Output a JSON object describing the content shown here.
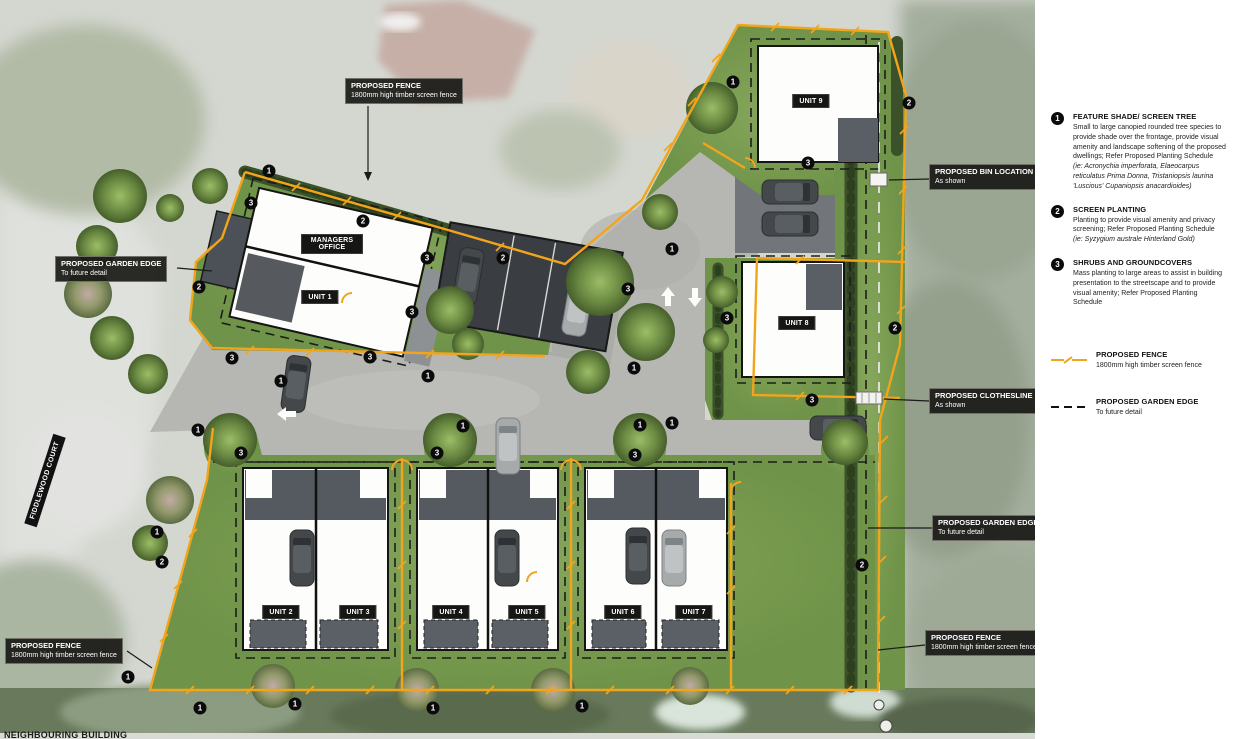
{
  "street_label": "FIDDLEWOOD COURT",
  "cropped_bottom_label": "NEIGHBOURING BUILDING",
  "units": [
    "MANAGERS OFFICE",
    "UNIT 1",
    "UNIT 2",
    "UNIT 3",
    "UNIT 4",
    "UNIT 5",
    "UNIT 6",
    "UNIT 7",
    "UNIT 8",
    "UNIT 9"
  ],
  "callouts": [
    {
      "title": "PROPOSED FENCE",
      "sub": "1800mm high timber screen fence"
    },
    {
      "title": "PROPOSED GARDEN EDGE",
      "sub": "To future detail"
    },
    {
      "title": "PROPOSED BIN LOCATION",
      "sub": "As shown"
    },
    {
      "title": "PROPOSED CLOTHESLINE",
      "sub": "As shown"
    },
    {
      "title": "PROPOSED GARDEN EDGE",
      "sub": "To future detail"
    },
    {
      "title": "PROPOSED FENCE",
      "sub": "1800mm high timber screen fence"
    },
    {
      "title": "PROPOSED FENCE",
      "sub": "1800mm high timber screen fence"
    }
  ],
  "legend": {
    "items": [
      {
        "num": "1",
        "title": "FEATURE SHADE/ SCREEN TREE",
        "body": "Small to large canopied rounded tree species to provide shade over the frontage, provide visual amenity and landscape softening of the proposed dwellings; Refer Proposed Planting Schedule",
        "species": "(ie: Acronychia imperforata, Elaeocarpus reticulatus Prima Donna, Tristaniopsis laurina 'Luscious' Cupaniopsis anacardioides)"
      },
      {
        "num": "2",
        "title": "SCREEN PLANTING",
        "body": "Planting to provide visual amenity and privacy screening; Refer Proposed Planting Schedule",
        "species": "(ie: Syzygium australe Hinterland Gold)"
      },
      {
        "num": "3",
        "title": "SHRUBS AND GROUNDCOVERS",
        "body": "Mass planting to large areas to assist in building presentation to the streetscape and to provide visual amenity; Refer Proposed Planting Schedule",
        "species": ""
      }
    ],
    "fence": {
      "title": "PROPOSED FENCE",
      "sub": "1800mm high timber screen fence"
    },
    "garden_edge": {
      "title": "PROPOSED GARDEN EDGE",
      "sub": "To future detail"
    }
  },
  "markers": [
    "1",
    "3",
    "2",
    "2",
    "3",
    "2",
    "3",
    "3",
    "3",
    "1",
    "1",
    "1",
    "3",
    "1",
    "2",
    "3",
    "3",
    "2",
    "1",
    "3",
    "1",
    "1",
    "3",
    "1",
    "3",
    "1",
    "3",
    "2",
    "1",
    "2",
    "1",
    "1",
    "1",
    "1",
    "1"
  ],
  "colors": {
    "fence": "#F2A51B",
    "garden_edge": "#1a1a1a",
    "marker_bg": "#0b0b0b",
    "callout_bg": "#191916",
    "grass": "#7C9E55",
    "hedge": "#3A5129",
    "driveway": "#B6B7B2",
    "building": "#FDFDFC",
    "garage": "#545A60"
  }
}
